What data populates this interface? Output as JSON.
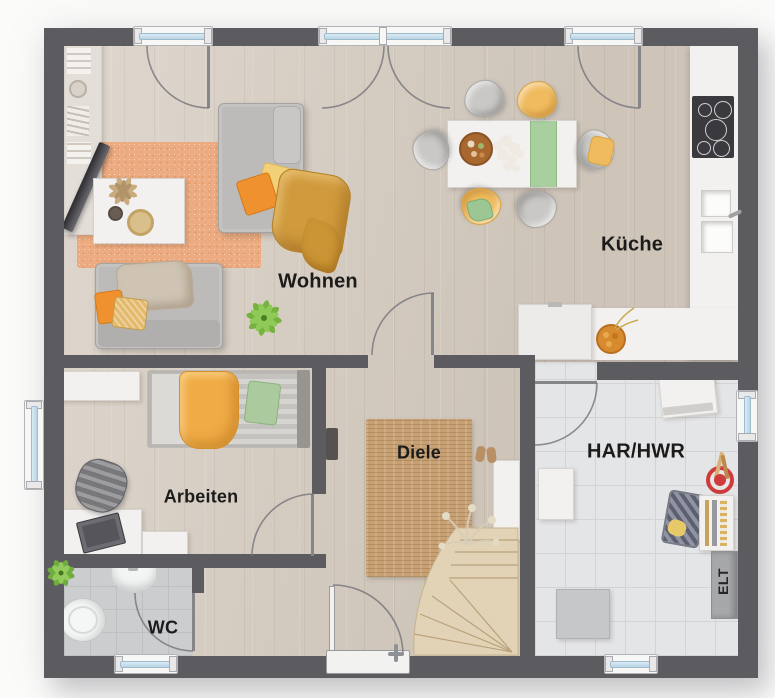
{
  "rooms": [
    {
      "id": "wohnen",
      "label": "Wohnen"
    },
    {
      "id": "kueche",
      "label": "Küche"
    },
    {
      "id": "arbeiten",
      "label": "Arbeiten"
    },
    {
      "id": "diele",
      "label": "Diele"
    },
    {
      "id": "wc",
      "label": "WC"
    },
    {
      "id": "har-hwr",
      "label": "HAR/HWR"
    },
    {
      "id": "elt",
      "label": "ELT"
    }
  ],
  "colors": {
    "wall": "#5b5b60",
    "wood_floor": "#d6ccc0",
    "wc_tile": "#cbcdcf",
    "har_tile": "#e4e5e7",
    "living_rug": "#ecab81",
    "hall_rug": "#c7a173",
    "stairs_wood": "#e2d3b6",
    "window_glass": "#cfe3ef",
    "accent_orange": "#f0912f",
    "accent_yellow": "#f2d077",
    "accent_mustard": "#d09a3d",
    "accent_green": "#a9cf9e",
    "label_text": "#1b1b1b"
  }
}
